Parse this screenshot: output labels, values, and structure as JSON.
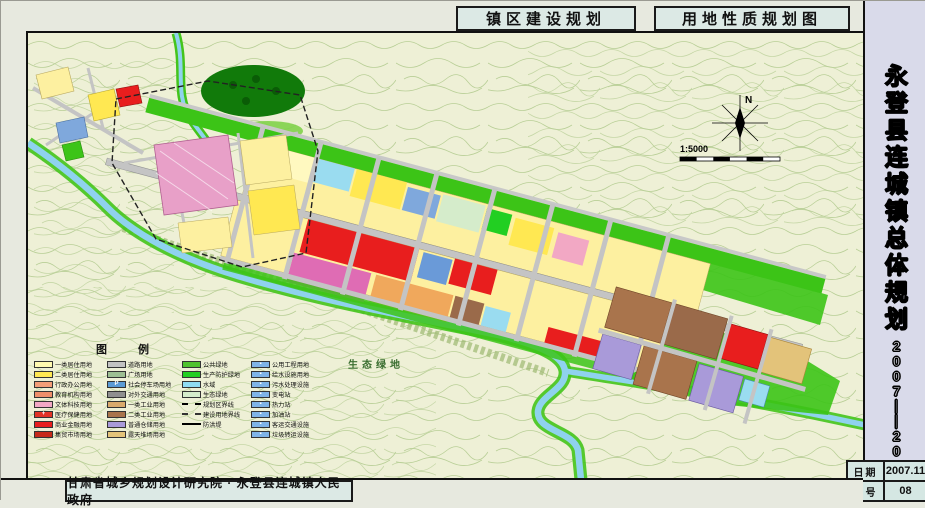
{
  "page": {
    "title_left": "镇区建设规划",
    "title_right": "用地性质规划图",
    "credit": "甘肃省城乡规划设计研究院 · 永登县连城镇人民政府"
  },
  "sidebar": {
    "title": "永登县连城镇总体规划",
    "period": "2007——2020",
    "date_label": "日期",
    "date_value": "2007.11",
    "sheet_label": "图号",
    "sheet_value": "08"
  },
  "map": {
    "north_label": "N",
    "scale_text": "1:5000",
    "eco_area_label": "生态绿地"
  },
  "legend": {
    "title": "图 例",
    "columns": [
      {
        "items": [
          {
            "swatch": "#fff9b0",
            "label": "一类居住用地"
          },
          {
            "swatch": "#ffe852",
            "label": "二类居住用地"
          },
          {
            "swatch": "#f49e78",
            "label": "行政办公用地"
          },
          {
            "swatch": "#ef8e6a",
            "label": "教育机构用地"
          },
          {
            "swatch": "#f2a8c4",
            "label": "文体科技用地"
          },
          {
            "swatch": "#e23326",
            "label": "医疗保健用地",
            "icon": "+"
          },
          {
            "swatch": "#e81e1e",
            "label": "商业金融用地"
          },
          {
            "swatch": "#c62a1a",
            "label": "集贸市场用地"
          }
        ]
      },
      {
        "items": [
          {
            "swatch": "#c2c2c2",
            "label": "道路用地"
          },
          {
            "swatch": "#9dbf93",
            "label": "广场用地"
          },
          {
            "swatch": "#5b9bd5",
            "label": "社会停车场用地",
            "icon": "P"
          },
          {
            "swatch": "#8f8f8f",
            "label": "对外交通用地"
          },
          {
            "swatch": "#d9a96c",
            "label": "一类工业用地"
          },
          {
            "swatch": "#a9744c",
            "label": "二类工业用地"
          },
          {
            "swatch": "#a99ad9",
            "label": "普通仓储用地"
          },
          {
            "swatch": "#e3c37a",
            "label": "露天堆场用地"
          }
        ]
      },
      {
        "items": [
          {
            "swatch": "#4fc32f",
            "label": "公共绿地"
          },
          {
            "swatch": "#22cf22",
            "label": "生产防护绿地"
          },
          {
            "swatch": "#8fdcf2",
            "label": "水域"
          },
          {
            "swatch": "#d5eccb",
            "label": "生态绿地"
          },
          {
            "line": "dashed",
            "label": "规划区界线"
          },
          {
            "line": "dashdot",
            "label": "建设用地界线"
          },
          {
            "line": "solid",
            "label": "防洪堤"
          }
        ]
      },
      {
        "items": [
          {
            "swatch": "#7fb4e8",
            "label": "公用工程用地",
            "icon": "▪"
          },
          {
            "swatch": "#7fb4e8",
            "label": "给水设施用地",
            "icon": "▪"
          },
          {
            "swatch": "#7fb4e8",
            "label": "污水处理设施",
            "icon": "▪"
          },
          {
            "swatch": "#7fb4e8",
            "label": "变电站",
            "icon": "▪"
          },
          {
            "swatch": "#7fb4e8",
            "label": "热力站",
            "icon": "▪"
          },
          {
            "swatch": "#7fb4e8",
            "label": "加油站",
            "icon": "▪"
          },
          {
            "swatch": "#7fb4e8",
            "label": "客运交通设施",
            "icon": "▪"
          },
          {
            "swatch": "#7fb4e8",
            "label": "垃圾转运设施",
            "icon": "▪"
          }
        ]
      }
    ]
  }
}
